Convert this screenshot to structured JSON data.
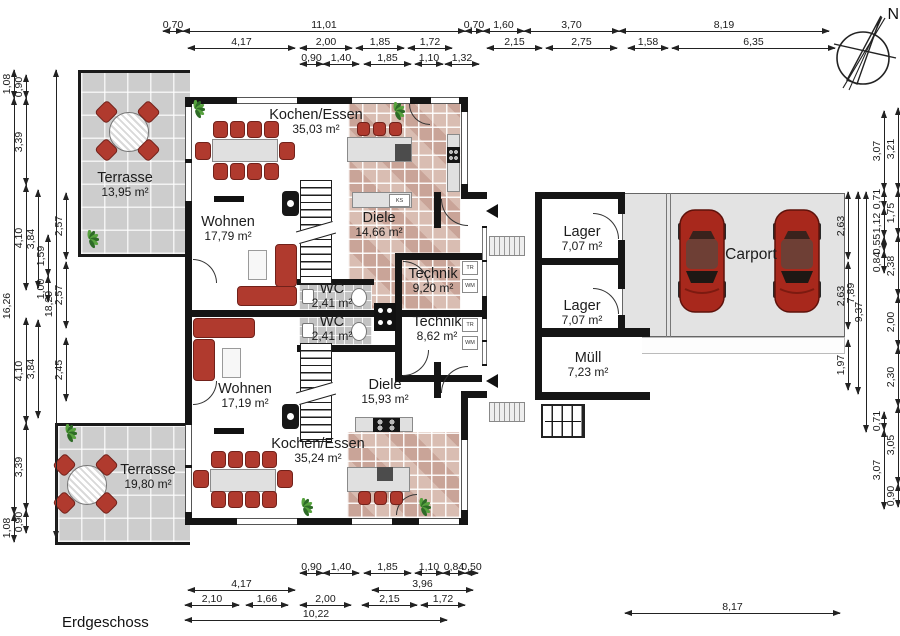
{
  "title": {
    "floor": "Erdgeschoss",
    "compass_n": "N"
  },
  "rooms": [
    {
      "id": "kochen-essen-top",
      "name": "Kochen/Essen",
      "area": "35,03 m²",
      "cx": 316,
      "cy": 107
    },
    {
      "id": "wohnen-top",
      "name": "Wohnen",
      "area": "17,79 m²",
      "cx": 228,
      "cy": 214
    },
    {
      "id": "diele-top",
      "name": "Diele",
      "area": "14,66 m²",
      "cx": 379,
      "cy": 210
    },
    {
      "id": "technik-top",
      "name": "Technik",
      "area": "9,20 m²",
      "cx": 433,
      "cy": 266
    },
    {
      "id": "wc-top",
      "name": "WC",
      "area": "2,41 m²",
      "cx": 332,
      "cy": 281
    },
    {
      "id": "wc-bottom",
      "name": "WC",
      "area": "2,41 m²",
      "cx": 332,
      "cy": 314
    },
    {
      "id": "technik-bottom",
      "name": "Technik",
      "area": "8,62 m²",
      "cx": 437,
      "cy": 314
    },
    {
      "id": "diele-bottom",
      "name": "Diele",
      "area": "15,93 m²",
      "cx": 385,
      "cy": 377
    },
    {
      "id": "wohnen-bottom",
      "name": "Wohnen",
      "area": "17,19 m²",
      "cx": 245,
      "cy": 381
    },
    {
      "id": "kochen-essen-bottom",
      "name": "Kochen/Essen",
      "area": "35,24 m²",
      "cx": 318,
      "cy": 436
    },
    {
      "id": "terrasse-top",
      "name": "Terrasse",
      "area": "13,95 m²",
      "cx": 125,
      "cy": 170
    },
    {
      "id": "terrasse-bottom",
      "name": "Terrasse",
      "area": "19,80 m²",
      "cx": 148,
      "cy": 462
    },
    {
      "id": "lager-top",
      "name": "Lager",
      "area": "7,07 m²",
      "cx": 582,
      "cy": 224
    },
    {
      "id": "lager-bottom",
      "name": "Lager",
      "area": "7,07 m²",
      "cx": 582,
      "cy": 298
    },
    {
      "id": "muell",
      "name": "Müll",
      "area": "7,23 m²",
      "cx": 588,
      "cy": 350
    },
    {
      "id": "carport",
      "name": "Carport",
      "area": "",
      "cx": 751,
      "cy": 246
    }
  ],
  "appliances": [
    {
      "label": "KS",
      "x": 389,
      "y": 194,
      "w": 21,
      "h": 13
    },
    {
      "label": "TR",
      "x": 462,
      "y": 261,
      "w": 16,
      "h": 14
    },
    {
      "label": "WM",
      "x": 462,
      "y": 279,
      "w": 16,
      "h": 14
    },
    {
      "label": "TR",
      "x": 462,
      "y": 318,
      "w": 16,
      "h": 14
    },
    {
      "label": "WM",
      "x": 462,
      "y": 336,
      "w": 16,
      "h": 14
    }
  ],
  "dims_h": [
    {
      "x1": 163,
      "x2": 183,
      "y": 31,
      "label": "0,70"
    },
    {
      "x1": 183,
      "x2": 465,
      "y": 31,
      "label": "11,01"
    },
    {
      "x1": 465,
      "x2": 483,
      "y": 31,
      "label": "0,70"
    },
    {
      "x1": 483,
      "x2": 524,
      "y": 31,
      "label": "1,60"
    },
    {
      "x1": 524,
      "x2": 619,
      "y": 31,
      "label": "3,70"
    },
    {
      "x1": 619,
      "x2": 829,
      "y": 31,
      "label": "8,19"
    },
    {
      "x1": 188,
      "x2": 295,
      "y": 48,
      "label": "4,17"
    },
    {
      "x1": 300,
      "x2": 352,
      "y": 48,
      "label": "2,00"
    },
    {
      "x1": 356,
      "x2": 404,
      "y": 48,
      "label": "1,85"
    },
    {
      "x1": 408,
      "x2": 452,
      "y": 48,
      "label": "1,72"
    },
    {
      "x1": 487,
      "x2": 542,
      "y": 48,
      "label": "2,15"
    },
    {
      "x1": 546,
      "x2": 617,
      "y": 48,
      "label": "2,75"
    },
    {
      "x1": 628,
      "x2": 668,
      "y": 48,
      "label": "1,58"
    },
    {
      "x1": 672,
      "x2": 835,
      "y": 48,
      "label": "6,35"
    },
    {
      "x1": 300,
      "x2": 323,
      "y": 64,
      "label": "0,90"
    },
    {
      "x1": 323,
      "x2": 359,
      "y": 64,
      "label": "1,40"
    },
    {
      "x1": 364,
      "x2": 411,
      "y": 64,
      "label": "1,85"
    },
    {
      "x1": 415,
      "x2": 443,
      "y": 64,
      "label": "1,10"
    },
    {
      "x1": 445,
      "x2": 479,
      "y": 64,
      "label": "1,32"
    },
    {
      "x1": 300,
      "x2": 323,
      "y": 573,
      "label": "0,90"
    },
    {
      "x1": 323,
      "x2": 359,
      "y": 573,
      "label": "1,40"
    },
    {
      "x1": 364,
      "x2": 411,
      "y": 573,
      "label": "1,85"
    },
    {
      "x1": 415,
      "x2": 443,
      "y": 573,
      "label": "1,10"
    },
    {
      "x1": 443,
      "x2": 465,
      "y": 573,
      "label": "0,84"
    },
    {
      "x1": 465,
      "x2": 478,
      "y": 573,
      "label": "0,50"
    },
    {
      "x1": 188,
      "x2": 295,
      "y": 590,
      "label": "4,17"
    },
    {
      "x1": 372,
      "x2": 473,
      "y": 590,
      "label": "3,96"
    },
    {
      "x1": 185,
      "x2": 239,
      "y": 605,
      "label": "2,10"
    },
    {
      "x1": 246,
      "x2": 288,
      "y": 605,
      "label": "1,66"
    },
    {
      "x1": 300,
      "x2": 351,
      "y": 605,
      "label": "2,00"
    },
    {
      "x1": 362,
      "x2": 417,
      "y": 605,
      "label": "2,15"
    },
    {
      "x1": 421,
      "x2": 465,
      "y": 605,
      "label": "1,72"
    },
    {
      "x1": 185,
      "x2": 447,
      "y": 620,
      "label": "10,22"
    },
    {
      "x1": 625,
      "x2": 840,
      "y": 613,
      "label": "8,17"
    }
  ],
  "dims_v": [
    {
      "x": 14,
      "y1": 70,
      "y2": 98,
      "label": "1,08"
    },
    {
      "x": 14,
      "y1": 98,
      "y2": 514,
      "label": "16,26"
    },
    {
      "x": 14,
      "y1": 514,
      "y2": 542,
      "label": "1,08"
    },
    {
      "x": 26,
      "y1": 75,
      "y2": 98,
      "label": "0,90"
    },
    {
      "x": 26,
      "y1": 98,
      "y2": 185,
      "label": "3,39"
    },
    {
      "x": 26,
      "y1": 185,
      "y2": 290,
      "label": "4,10"
    },
    {
      "x": 26,
      "y1": 318,
      "y2": 423,
      "label": "4,10"
    },
    {
      "x": 26,
      "y1": 423,
      "y2": 510,
      "label": "3,39"
    },
    {
      "x": 26,
      "y1": 510,
      "y2": 533,
      "label": "0,90"
    },
    {
      "x": 38,
      "y1": 190,
      "y2": 288,
      "label": "3,84"
    },
    {
      "x": 38,
      "y1": 320,
      "y2": 418,
      "label": "3,84"
    },
    {
      "x": 48,
      "y1": 235,
      "y2": 276,
      "label": "1,59"
    },
    {
      "x": 48,
      "y1": 276,
      "y2": 302,
      "label": "1,00"
    },
    {
      "x": 56,
      "y1": 70,
      "y2": 538,
      "label": "18,29"
    },
    {
      "x": 66,
      "y1": 193,
      "y2": 259,
      "label": "2,57"
    },
    {
      "x": 66,
      "y1": 262,
      "y2": 328,
      "label": "2,57"
    },
    {
      "x": 66,
      "y1": 338,
      "y2": 401,
      "label": "2,45"
    },
    {
      "x": 848,
      "y1": 192,
      "y2": 259,
      "label": "2,63"
    },
    {
      "x": 848,
      "y1": 262,
      "y2": 329,
      "label": "2,63"
    },
    {
      "x": 848,
      "y1": 340,
      "y2": 390,
      "label": "1,97"
    },
    {
      "x": 858,
      "y1": 192,
      "y2": 394,
      "label": "7,89"
    },
    {
      "x": 866,
      "y1": 192,
      "y2": 432,
      "label": "9,37"
    },
    {
      "x": 884,
      "y1": 111,
      "y2": 190,
      "label": "3,07"
    },
    {
      "x": 884,
      "y1": 190,
      "y2": 208,
      "label": "0,71"
    },
    {
      "x": 884,
      "y1": 208,
      "y2": 237,
      "label": "1,12"
    },
    {
      "x": 884,
      "y1": 237,
      "y2": 251,
      "label": "0,55"
    },
    {
      "x": 884,
      "y1": 251,
      "y2": 273,
      "label": "0,84"
    },
    {
      "x": 884,
      "y1": 412,
      "y2": 430,
      "label": "0,71"
    },
    {
      "x": 884,
      "y1": 430,
      "y2": 509,
      "label": "3,07"
    },
    {
      "x": 898,
      "y1": 108,
      "y2": 190,
      "label": "3,21"
    },
    {
      "x": 898,
      "y1": 190,
      "y2": 235,
      "label": "1,75"
    },
    {
      "x": 898,
      "y1": 235,
      "y2": 296,
      "label": "2,38"
    },
    {
      "x": 898,
      "y1": 296,
      "y2": 347,
      "label": "2,00"
    },
    {
      "x": 898,
      "y1": 347,
      "y2": 406,
      "label": "2,30"
    },
    {
      "x": 898,
      "y1": 406,
      "y2": 484,
      "label": "3,05"
    },
    {
      "x": 898,
      "y1": 484,
      "y2": 507,
      "label": "0,90"
    }
  ],
  "colors": {
    "wall": "#151515",
    "accent_red": "#b03a2e",
    "kitchen_tile": "#d9bdb2",
    "terrace_tile": "#cdcdcd",
    "carport_slab": "#e3e3e3"
  }
}
